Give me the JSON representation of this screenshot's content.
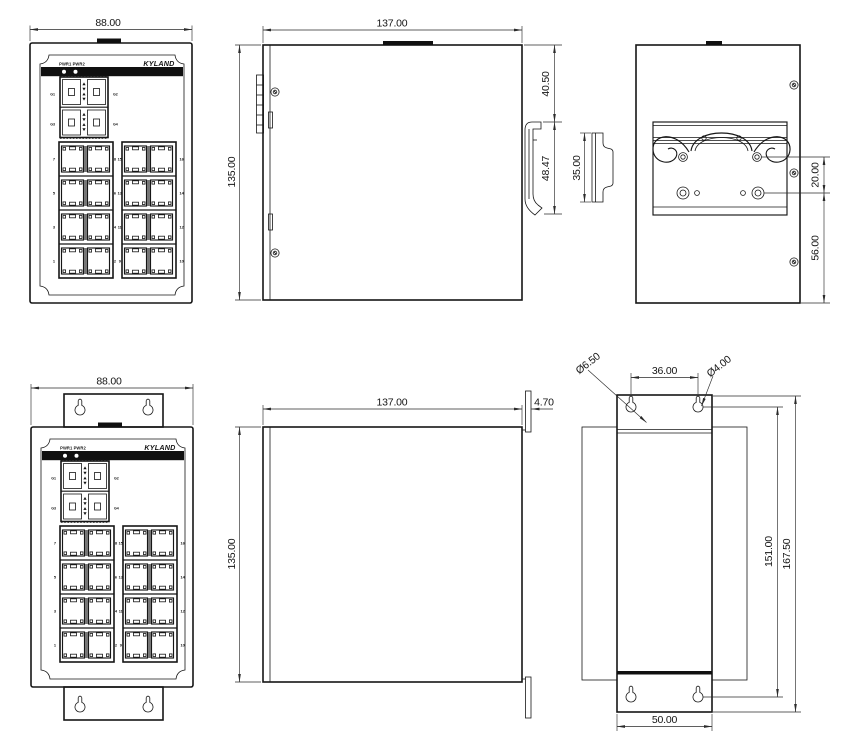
{
  "drawing": {
    "dims": {
      "front_din_width": "88.00",
      "side_din_width": "137.00",
      "side_din_height": "135.00",
      "side_din_clip_offset": "40.50",
      "side_din_clip_length": "48.47",
      "din_rail_height": "35.00",
      "rear_din_hole_pitch": "20.00",
      "rear_din_bottom_offset": "56.00",
      "front_wall_width": "88.00",
      "side_wall_width": "137.00",
      "side_wall_height": "135.00",
      "side_wall_plate_thickness": "4.70",
      "rear_wall_big_hole": "Ø6.50",
      "rear_wall_hole_pitch_x": "36.00",
      "rear_wall_small_hole": "Ø4.00",
      "rear_wall_hole_pitch_y": "151.00",
      "rear_wall_plate_height": "167.50",
      "rear_wall_plate_width": "50.00"
    },
    "panel": {
      "logo": "KYLAND",
      "power_leds": "PWR1 PWR2",
      "sfp": {
        "g1": "G1",
        "g2": "G2",
        "g3": "G3",
        "g4": "G4"
      },
      "ports": {
        "left_outer": [
          "7",
          "5",
          "3",
          "1"
        ],
        "left_inner": [
          "8",
          "6",
          "4",
          "2"
        ],
        "right_inner": [
          "15",
          "13",
          "11",
          "9"
        ],
        "right_outer": [
          "16",
          "14",
          "12",
          "10"
        ]
      }
    },
    "colors": {
      "line": "#161616",
      "background": "#ffffff"
    }
  }
}
